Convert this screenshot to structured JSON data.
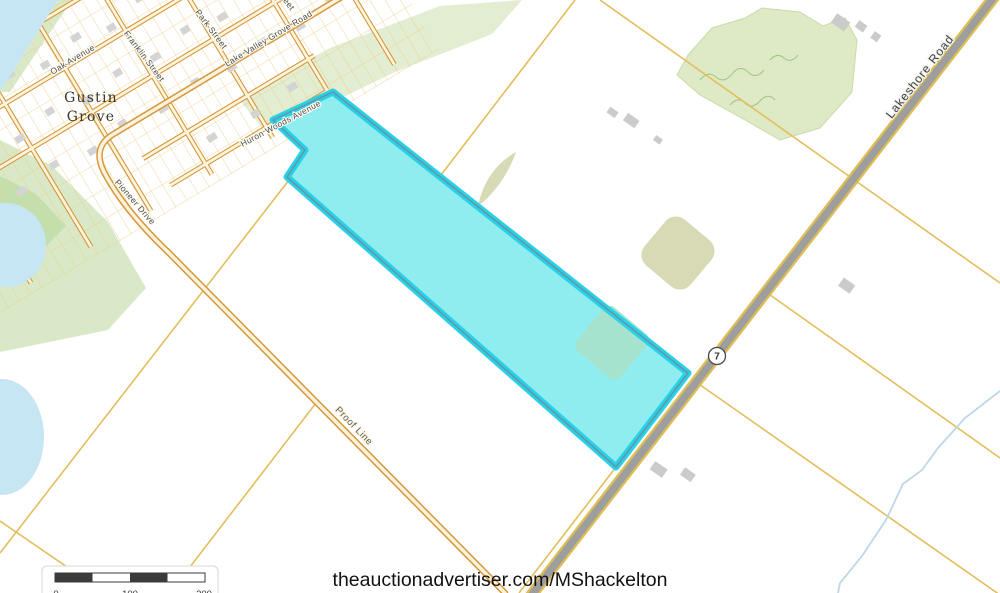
{
  "map": {
    "place_label": {
      "line1": "Gustin",
      "line2": "Grove"
    },
    "streets": [
      {
        "id": "oak-avenue",
        "label": "Oak Avenue"
      },
      {
        "id": "franklin-street",
        "label": "Franklin Street"
      },
      {
        "id": "park-street",
        "label": "Park Street"
      },
      {
        "id": "lake-valley-grove-road",
        "label": "Lake Valley Grove Road"
      },
      {
        "id": "pioneer-drive",
        "label": "Pioneer Drive"
      },
      {
        "id": "huron-woods-avenue",
        "label": "Huron Woods Avenue"
      },
      {
        "id": "proof-line",
        "label": "Proof Line"
      },
      {
        "id": "lakeshore-road",
        "label": "Lakeshore Road"
      },
      {
        "id": "street-fragment",
        "label": "Street"
      }
    ],
    "route_shield": {
      "number": "7"
    },
    "scale_bar": {
      "labels": [
        "0",
        "100",
        "200"
      ]
    },
    "attribution": "theauctionadvertiser.com/MShackelton",
    "colors": {
      "water": "#C5E6F2",
      "parcel_fill": "#90EDEF",
      "parcel_outline": "#25D2E8",
      "parcel_inner_line": "#7191A3",
      "field_patch": "#D8DAB5",
      "field_under_parcel": "#A6E3CE",
      "woodland": "#DEE9C5",
      "shore_green": "#D9E9C8",
      "road_minor_casing": "#D6973C",
      "road_major_gray": "#9E9E9E",
      "lot_line": "#E3BE5C",
      "building": "#D4D4D4",
      "creek": "#BCD8E8"
    }
  }
}
